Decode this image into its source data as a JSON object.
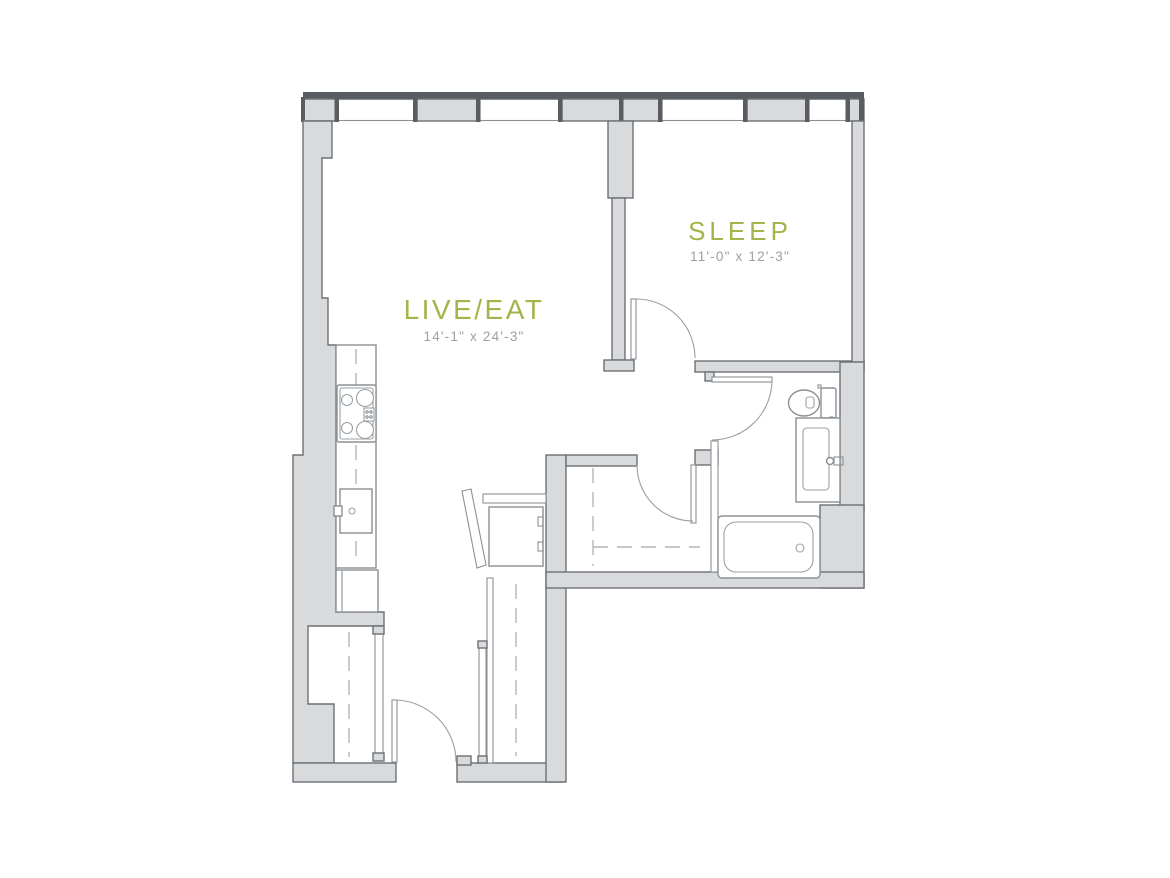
{
  "floorplan": {
    "type": "apartment-floor-plan",
    "rooms": [
      {
        "id": "sleep",
        "label": "SLEEP",
        "dimensions": "11'-0\" x 12'-3\""
      },
      {
        "id": "live-eat",
        "label": "LIVE/EAT",
        "dimensions": "14'-1\" x 24'-3\""
      }
    ],
    "fixtures": [
      "cooktop",
      "kitchen-sink",
      "refrigerator",
      "washer-dryer",
      "toilet",
      "vanity-sink",
      "bathtub",
      "entry-door",
      "bedroom-door",
      "bathroom-door",
      "closet-door",
      "closet-rod-dashed-lines",
      "window-band"
    ],
    "colors": {
      "room_label": "#a6b24a",
      "dimension_text": "#9ba0a2",
      "wall_fill": "#d8dadc",
      "wall_outline": "#6d7175",
      "window_frame": "#595d61",
      "floor": "#ffffff"
    }
  }
}
